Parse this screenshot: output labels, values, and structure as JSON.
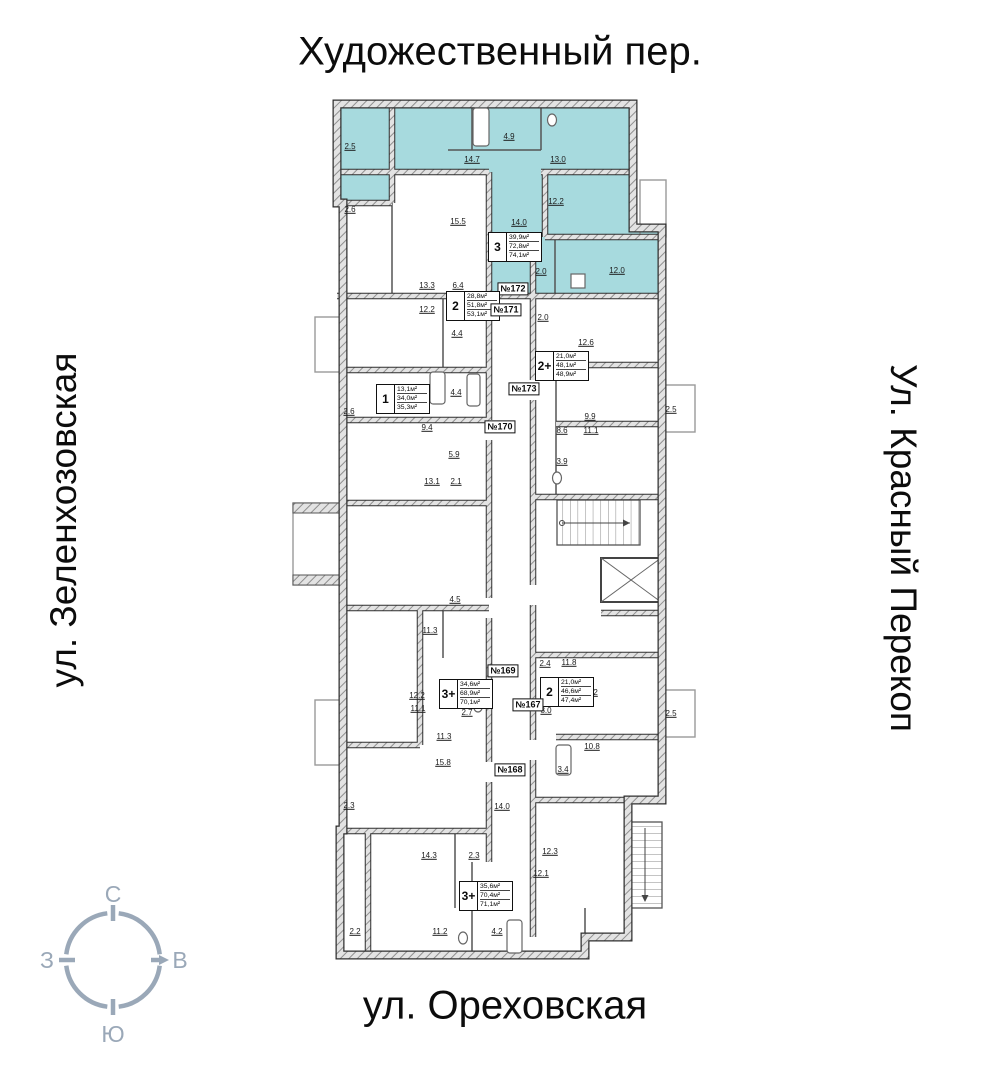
{
  "streets": {
    "top": "Художественный пер.",
    "left": "ул. Зеленхозовская",
    "right": "Ул. Красный Перекоп",
    "bottom": "ул. Ореховская"
  },
  "compass": {
    "north": "С",
    "south": "Ю",
    "west": "З",
    "east": "В",
    "color": "#9aa8b8"
  },
  "plan": {
    "highlight_color": "#a7dade",
    "apartments": [
      {
        "tag": "№172",
        "type": "3",
        "areas": [
          "39,9м²",
          "72,8м²",
          "74,1м²"
        ],
        "highlighted": true,
        "box": {
          "x": 488,
          "y": 232
        },
        "tagpos": {
          "x": 513,
          "y": 289
        }
      },
      {
        "tag": "№171",
        "type": "2",
        "areas": [
          "28,8м²",
          "51,8м²",
          "53,1м²"
        ],
        "highlighted": false,
        "box": {
          "x": 446,
          "y": 291
        },
        "tagpos": {
          "x": 506,
          "y": 310
        }
      },
      {
        "tag": "№173",
        "type": "2+",
        "areas": [
          "21,0м²",
          "48,1м²",
          "48,9м²"
        ],
        "highlighted": false,
        "box": {
          "x": 535,
          "y": 351
        },
        "tagpos": {
          "x": 524,
          "y": 389
        }
      },
      {
        "tag": "№170",
        "type": "1",
        "areas": [
          "13,1м²",
          "34,0м²",
          "35,3м²"
        ],
        "highlighted": false,
        "box": {
          "x": 376,
          "y": 384
        },
        "tagpos": {
          "x": 500,
          "y": 427
        }
      },
      {
        "tag": "№169",
        "type": "3+",
        "areas": [
          "34,6м²",
          "68,9м²",
          "70,1м²"
        ],
        "highlighted": false,
        "box": {
          "x": 439,
          "y": 679
        },
        "tagpos": {
          "x": 503,
          "y": 671
        }
      },
      {
        "tag": "№167",
        "type": "2",
        "areas": [
          "21,0м²",
          "46,6м²",
          "47,4м²"
        ],
        "highlighted": false,
        "box": {
          "x": 540,
          "y": 677
        },
        "tagpos": {
          "x": 528,
          "y": 705
        }
      },
      {
        "tag": "№168",
        "type": "3+",
        "areas": [
          "35,6м²",
          "70,4м²",
          "71,1м²"
        ],
        "highlighted": false,
        "box": {
          "x": 459,
          "y": 881
        },
        "tagpos": {
          "x": 510,
          "y": 770
        }
      }
    ],
    "dimensions": [
      {
        "x": 350,
        "y": 147,
        "t": "2.5"
      },
      {
        "x": 472,
        "y": 160,
        "t": "14.7"
      },
      {
        "x": 509,
        "y": 137,
        "t": "4.9"
      },
      {
        "x": 558,
        "y": 160,
        "t": "13.0"
      },
      {
        "x": 556,
        "y": 202,
        "t": "12.2"
      },
      {
        "x": 519,
        "y": 223,
        "t": "14.0"
      },
      {
        "x": 541,
        "y": 272,
        "t": "2.0"
      },
      {
        "x": 617,
        "y": 271,
        "t": "12.0"
      },
      {
        "x": 350,
        "y": 210,
        "t": "2.6"
      },
      {
        "x": 458,
        "y": 222,
        "t": "15.5"
      },
      {
        "x": 427,
        "y": 286,
        "t": "13.3"
      },
      {
        "x": 458,
        "y": 286,
        "t": "6.4"
      },
      {
        "x": 427,
        "y": 310,
        "t": "12.2"
      },
      {
        "x": 457,
        "y": 334,
        "t": "4.4"
      },
      {
        "x": 543,
        "y": 318,
        "t": "2.0"
      },
      {
        "x": 586,
        "y": 343,
        "t": "12.6"
      },
      {
        "x": 349,
        "y": 412,
        "t": "2.6"
      },
      {
        "x": 456,
        "y": 393,
        "t": "4.4"
      },
      {
        "x": 427,
        "y": 428,
        "t": "9.4"
      },
      {
        "x": 454,
        "y": 455,
        "t": "5.9"
      },
      {
        "x": 432,
        "y": 482,
        "t": "13.1"
      },
      {
        "x": 456,
        "y": 482,
        "t": "2.1"
      },
      {
        "x": 590,
        "y": 417,
        "t": "9.9"
      },
      {
        "x": 562,
        "y": 431,
        "t": "8.6"
      },
      {
        "x": 591,
        "y": 431,
        "t": "11.1"
      },
      {
        "x": 562,
        "y": 462,
        "t": "3.9"
      },
      {
        "x": 671,
        "y": 410,
        "t": "2.5"
      },
      {
        "x": 455,
        "y": 600,
        "t": "4.5"
      },
      {
        "x": 430,
        "y": 631,
        "t": "11.3"
      },
      {
        "x": 545,
        "y": 664,
        "t": "2.4"
      },
      {
        "x": 569,
        "y": 663,
        "t": "11.8"
      },
      {
        "x": 417,
        "y": 696,
        "t": "12.2"
      },
      {
        "x": 418,
        "y": 709,
        "t": "11.1"
      },
      {
        "x": 467,
        "y": 713,
        "t": "2.7"
      },
      {
        "x": 444,
        "y": 737,
        "t": "11.3"
      },
      {
        "x": 443,
        "y": 763,
        "t": "15.8"
      },
      {
        "x": 590,
        "y": 693,
        "t": "10.2"
      },
      {
        "x": 546,
        "y": 711,
        "t": "8.0"
      },
      {
        "x": 592,
        "y": 747,
        "t": "10.8"
      },
      {
        "x": 671,
        "y": 714,
        "t": "2.5"
      },
      {
        "x": 563,
        "y": 770,
        "t": "3.4"
      },
      {
        "x": 502,
        "y": 807,
        "t": "14.0"
      },
      {
        "x": 349,
        "y": 806,
        "t": "2.3"
      },
      {
        "x": 429,
        "y": 856,
        "t": "14.3"
      },
      {
        "x": 474,
        "y": 856,
        "t": "2.3"
      },
      {
        "x": 550,
        "y": 852,
        "t": "12.3"
      },
      {
        "x": 541,
        "y": 874,
        "t": "12.1"
      },
      {
        "x": 355,
        "y": 932,
        "t": "2.2"
      },
      {
        "x": 440,
        "y": 932,
        "t": "11.2"
      },
      {
        "x": 497,
        "y": 932,
        "t": "4.2"
      }
    ]
  }
}
